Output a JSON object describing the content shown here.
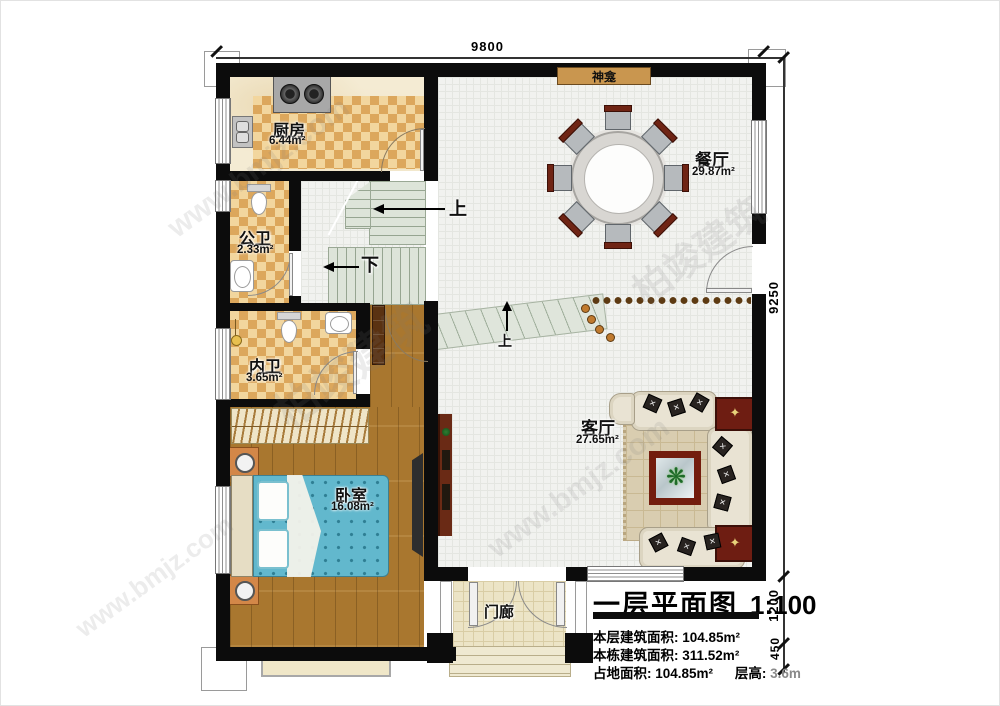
{
  "dimensions": {
    "width_total": "9800",
    "height_main": "9250",
    "porch_depth": "1200",
    "step_depth": "450"
  },
  "rooms": {
    "kitchen": {
      "name": "厨房",
      "area": "6.44m²"
    },
    "public_bath": {
      "name": "公卫",
      "area": "2.33m²"
    },
    "inner_bath": {
      "name": "内卫",
      "area": "3.65m²"
    },
    "bedroom": {
      "name": "卧室",
      "area": "16.08m²"
    },
    "dining": {
      "name": "餐厅",
      "area": "29.87m²"
    },
    "living": {
      "name": "客厅",
      "area": "27.65m²"
    },
    "porch": {
      "name": "门廊"
    }
  },
  "annotations": {
    "shrine": "神龛",
    "stairs_up": "上",
    "stairs_down": "下",
    "entry_up": "上"
  },
  "title_block": {
    "title": "一层平面图",
    "scale": "1:100",
    "row1_label": "本层建筑面积:",
    "row1_value": "104.85m²",
    "row2_label": "本栋建筑面积:",
    "row2_value": "311.52m²",
    "row3_label": "占地面积:",
    "row3_value": "104.85m²",
    "row3b_label": "层高:",
    "row3b_value": "3.6m"
  },
  "watermark": {
    "text_cn": "柏竣建筑",
    "text_url": "www.bmjz.com"
  },
  "colors": {
    "wall": "#0c0c0c",
    "wood_floor": "#a9772f",
    "bed_blue": "#62b8cd",
    "shrine_fill": "#c9964f",
    "stair_green": "#dde4d9",
    "rug_tan": "#d9cdb0",
    "table_red": "#731d0e"
  }
}
